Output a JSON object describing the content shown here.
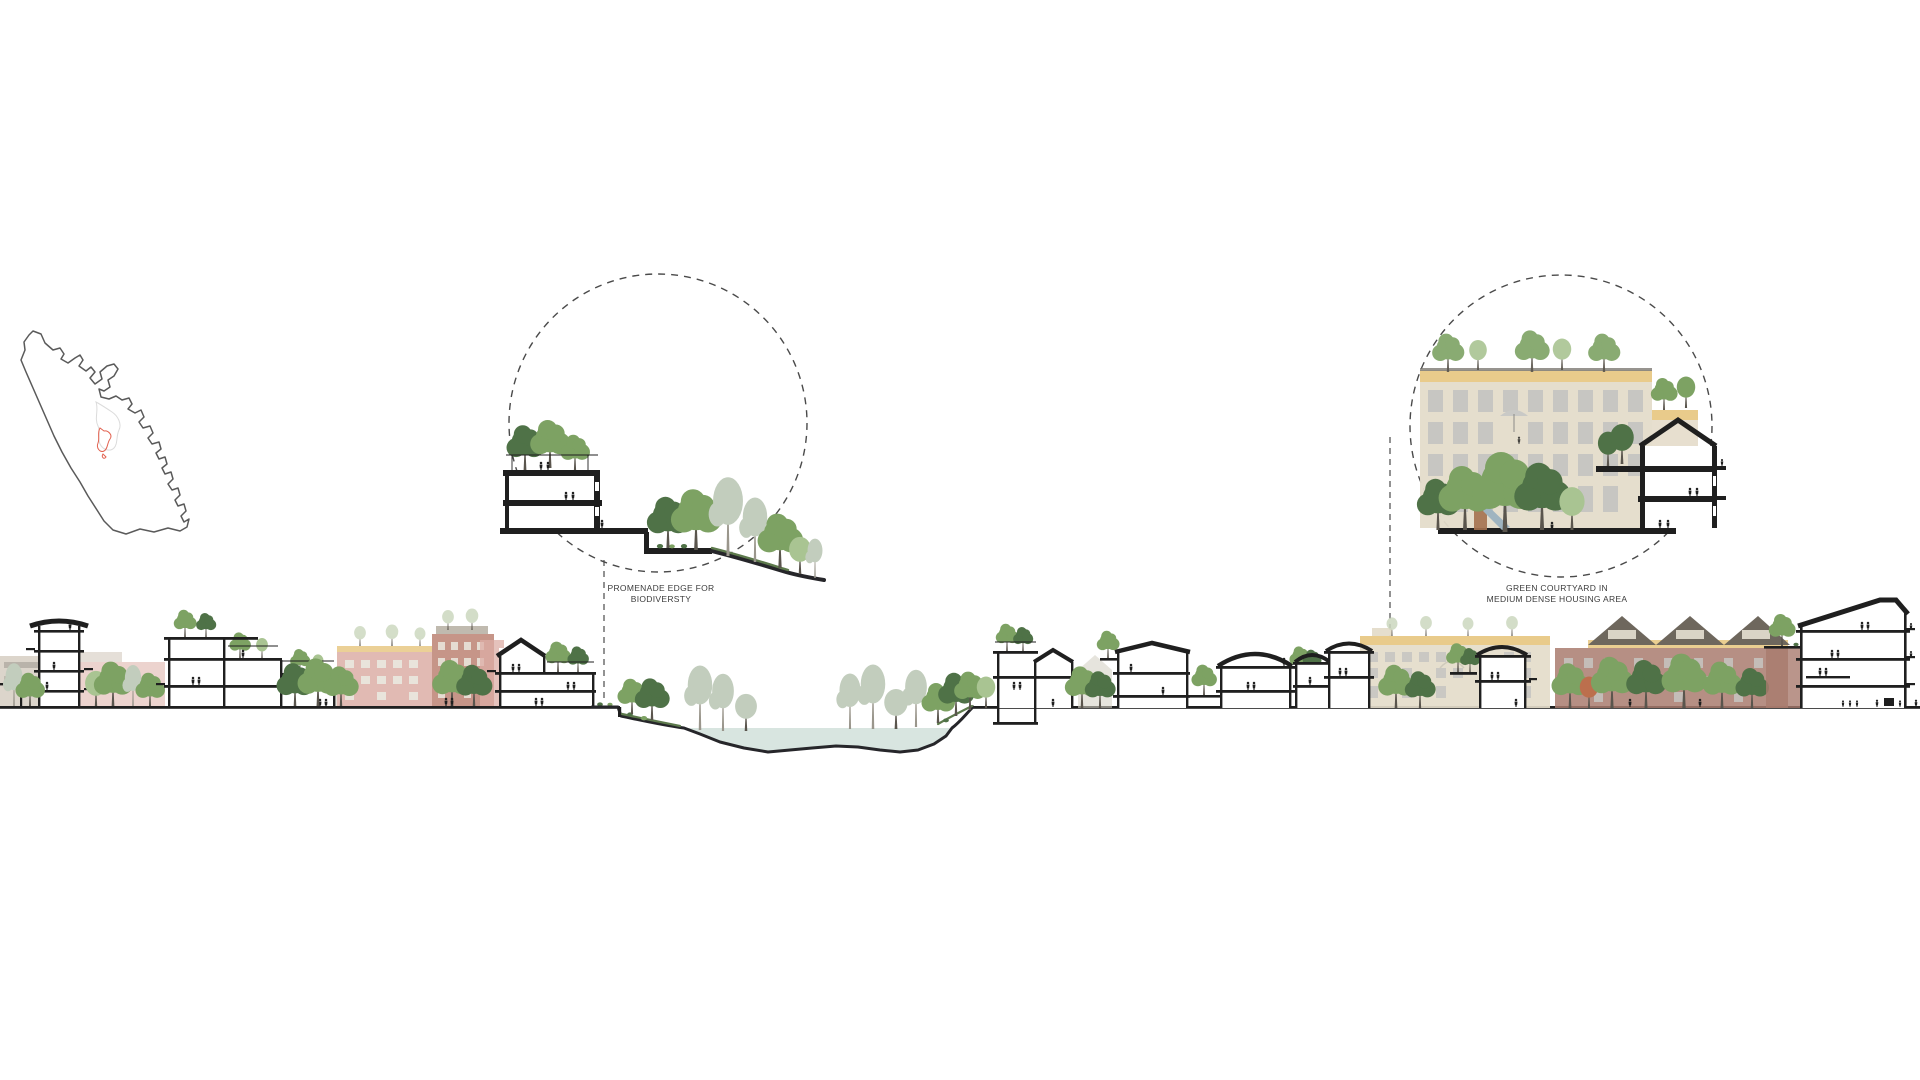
{
  "figure": {
    "description": "Urban design sectional diagram with location map and two detail callouts"
  },
  "map": {
    "name": "location-map",
    "highlight": "municipal boundary with red project-site outline"
  },
  "callouts": {
    "promenade": {
      "line1": "PROMENADE EDGE FOR",
      "line2": "BIODIVERSTY"
    },
    "courtyard": {
      "line1": "GREEN COURTYARD IN",
      "line2": "MEDIUM DENSE HOUSING AREA"
    }
  },
  "colors": {
    "ink": "#1f1f1f",
    "dash": "#4a4a4a",
    "label": "#3c3c3c",
    "water": "#d8e5e0",
    "grass": "#5d7a4c",
    "tree-dark": "#4f7247",
    "tree-mid": "#7da263",
    "tree-light": "#a9c492",
    "tree-faded": "#c2cdbd",
    "tree-pale": "#ccd8bf",
    "facade-pink": "#dcaea6",
    "facade-red": "#c08a7b",
    "brick": "#a97b6e",
    "beige": "#e4dcca",
    "band-yellow": "#e9cb8b",
    "roof-dark": "#6e675d",
    "muted": "#d3cabe",
    "window": "#c7c6c2",
    "map-line": "#5a5a5a",
    "map-red": "#e2614f"
  }
}
